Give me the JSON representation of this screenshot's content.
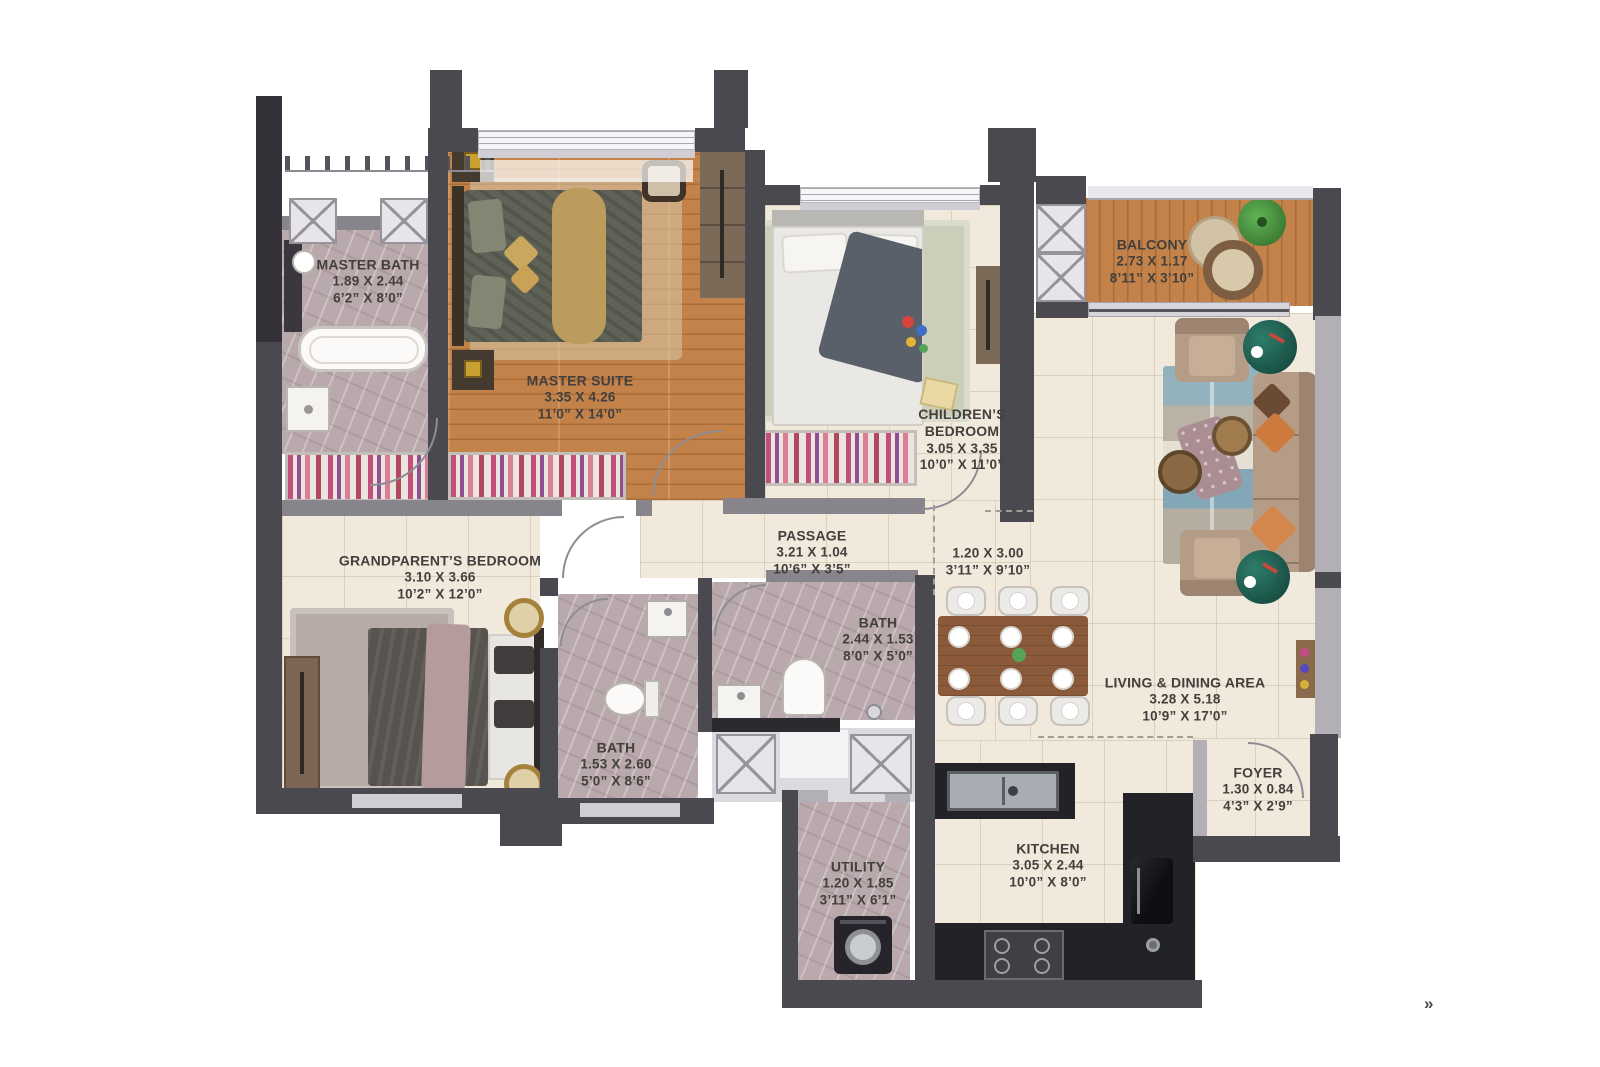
{
  "rooms": {
    "master_bath": {
      "name": "MASTER BATH",
      "metric": "1.89 X 2.44",
      "imperial": "6’2” X 8’0”"
    },
    "master_suite": {
      "name": "MASTER SUITE",
      "metric": "3.35 X 4.26",
      "imperial": "11’0” X 14’0”"
    },
    "childrens_bedroom": {
      "name": "CHILDREN’S BEDROOM",
      "metric": "3.05 X 3.35",
      "imperial": "10’0” X 11’0”"
    },
    "balcony": {
      "name": "BALCONY",
      "metric": "2.73 X 1.17",
      "imperial": "8’11” X 3’10”"
    },
    "grandparents_bedroom": {
      "name": "GRANDPARENT’S BEDROOM",
      "metric": "3.10 X 3.66",
      "imperial": "10’2” X 12’0”"
    },
    "passage": {
      "name": "PASSAGE",
      "metric": "3.21 X 1.04",
      "imperial": "10’6” X 3’5”"
    },
    "corridor": {
      "name": "",
      "metric": "1.20 X 3.00",
      "imperial": "3’11” X 9’10”"
    },
    "bath_common": {
      "name": "BATH",
      "metric": "2.44 X 1.53",
      "imperial": "8’0” X 5’0”"
    },
    "bath_gp": {
      "name": "BATH",
      "metric": "1.53 X 2.60",
      "imperial": "5’0” X 8’6”"
    },
    "living_dining": {
      "name": "LIVING & DINING AREA",
      "metric": "3.28 X 5.18",
      "imperial": "10’9” X 17’0”"
    },
    "foyer": {
      "name": "FOYER",
      "metric": "1.30 X 0.84",
      "imperial": "4’3” X 2’9”"
    },
    "utility": {
      "name": "UTILITY",
      "metric": "1.20 X 1.85",
      "imperial": "3’11” X 6’1”"
    },
    "kitchen": {
      "name": "KITCHEN",
      "metric": "3.05 X 2.44",
      "imperial": "10’0” X 8’0”"
    }
  },
  "entry_marker": "»",
  "palette": {
    "wall": "#4b4950",
    "wall_dark": "#343139",
    "wall_light": "#b2b0b6",
    "wood_floor": "#c2824a",
    "tile_floor": "#f0e9dc",
    "marble_floor": "#b9a9ac",
    "label_text": "#433f3d",
    "accent_green_table": "#1d5a4e",
    "accent_orange_pillow": "#cd7a3e",
    "gold_runner": "#bb9c5c",
    "rug_blue": "#84a7b7",
    "counter_dark": "#232226"
  }
}
